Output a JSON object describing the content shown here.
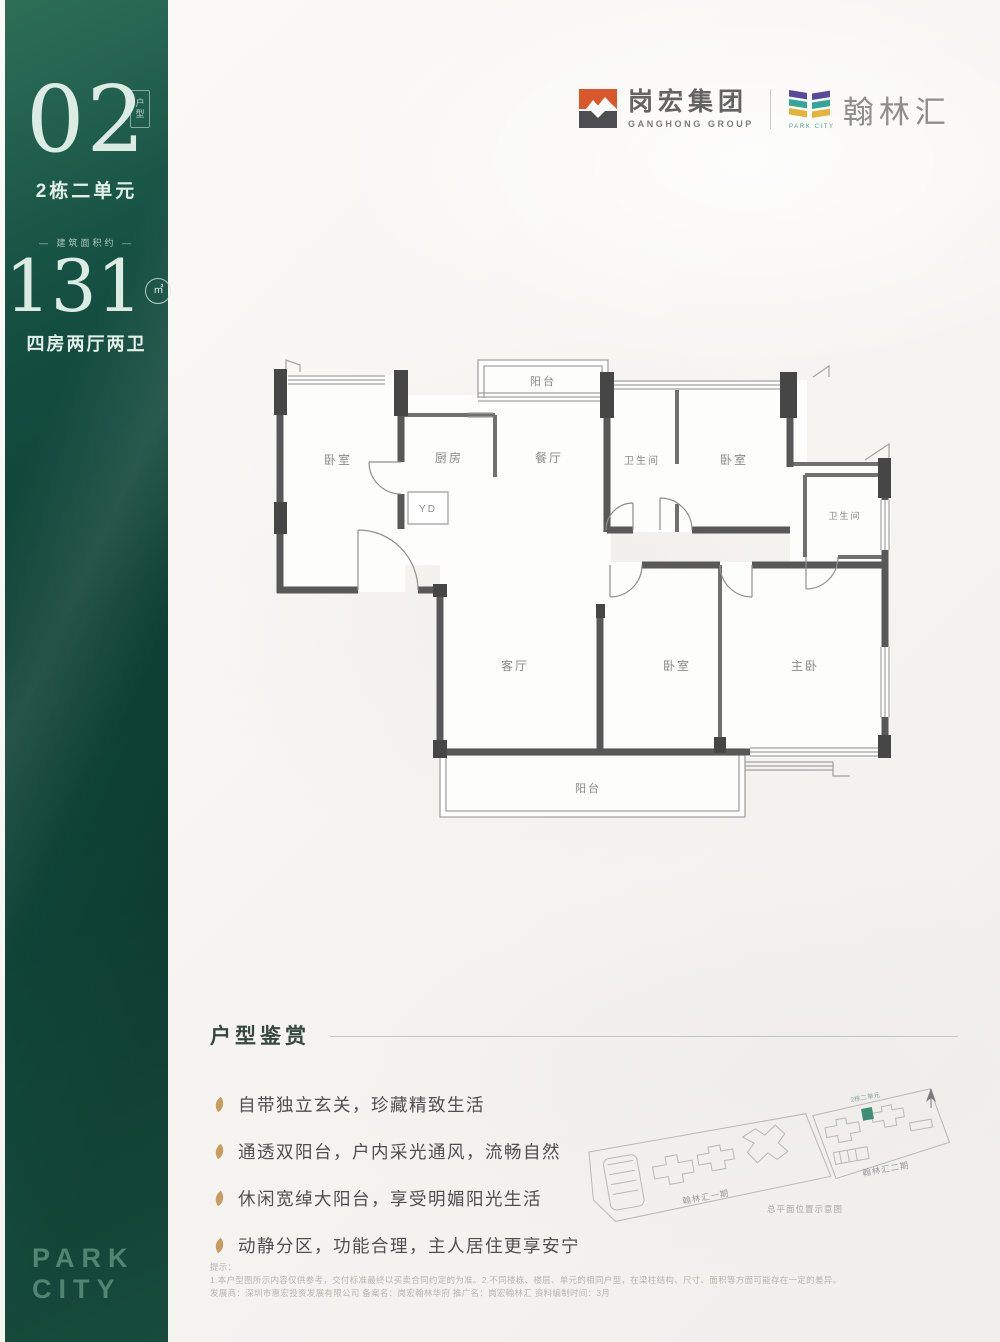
{
  "sidebar": {
    "unit_number": "02",
    "unit_tag": "户型",
    "unit_name": "2栋二单元",
    "area_label": "— 建筑面积约 —",
    "area_value": "131",
    "area_unit": "㎡",
    "layout_desc": "四房两厅两卫",
    "brand_top": "PARK",
    "brand_bottom": "CITY"
  },
  "header": {
    "developer_cn": "岗宏集团",
    "developer_en": "GANGHONG GROUP",
    "project_cn": "翰林汇",
    "project_en": "PARK CITY"
  },
  "floorplan": {
    "rooms": {
      "balcony_top": "阳台",
      "bedroom1": "卧室",
      "kitchen": "厨房",
      "yd": "YD",
      "dining": "餐厅",
      "bath1": "卫生间",
      "bedroom2": "卧室",
      "bath2": "卫生间",
      "living": "客厅",
      "bedroom3": "卧室",
      "master": "主卧",
      "balcony_bottom": "阳台"
    }
  },
  "features": {
    "title": "户型鉴赏",
    "items": [
      "自带独立玄关，珍藏精致生活",
      "通透双阳台，户内采光通风，流畅自然",
      "休闲宽绰大阳台，享受明媚阳光生活",
      "动静分区，功能合理，主人居住更享安宁"
    ]
  },
  "sitemap": {
    "phase1": "翰林汇一期",
    "phase2": "翰林汇二期",
    "highlight": "2栋二单元",
    "caption": "总平面位置示意图"
  },
  "disclaimer": {
    "title": "提示：",
    "line1": "1.本户型图所示内容仅供参考，交付标准最终以买卖合同约定的为准。2.不同楼栋、楼层、单元的相同户型，在梁柱结构、尺寸、面积等方面可能存在一定的差异。",
    "line2": "发展商：深圳市惠宏投资发展有限公司 备案名：岗宏翰林华府 推广名：岗宏翰林汇 资料编制时间：3月"
  },
  "colors": {
    "accent_green": "#0e4335",
    "logo_orange": "#d9572b",
    "logo_purple": "#584a99",
    "logo_teal": "#31a79c",
    "logo_yellow": "#e3b33c",
    "bullet_gold": "#c89c5e",
    "highlight_green": "#3f8f77"
  }
}
